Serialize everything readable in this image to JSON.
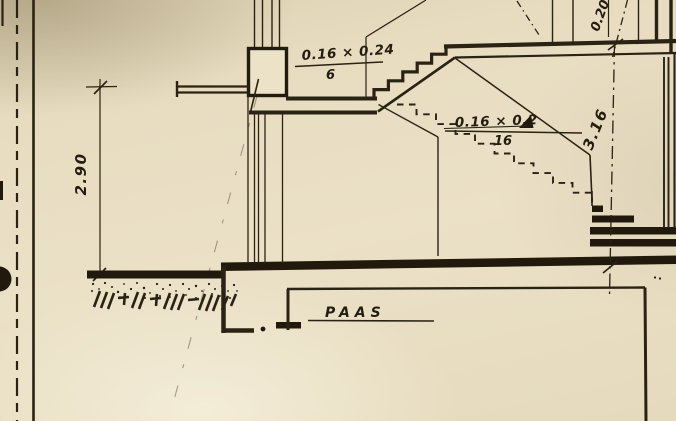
{
  "drawing": {
    "labels": {
      "upper_flight_dim": "0.16 × 0.24",
      "upper_flight_count": "6",
      "lower_flight_dim": "0.16 × 0.2",
      "lower_flight_count": "16",
      "left_height_dim": "2.90",
      "right_height_dim": "3.16",
      "top_right_dim": "0.20",
      "foundation_label": "PAAS"
    },
    "colors": {
      "paper": "#e9dec3",
      "ink": "#2a2213"
    }
  }
}
